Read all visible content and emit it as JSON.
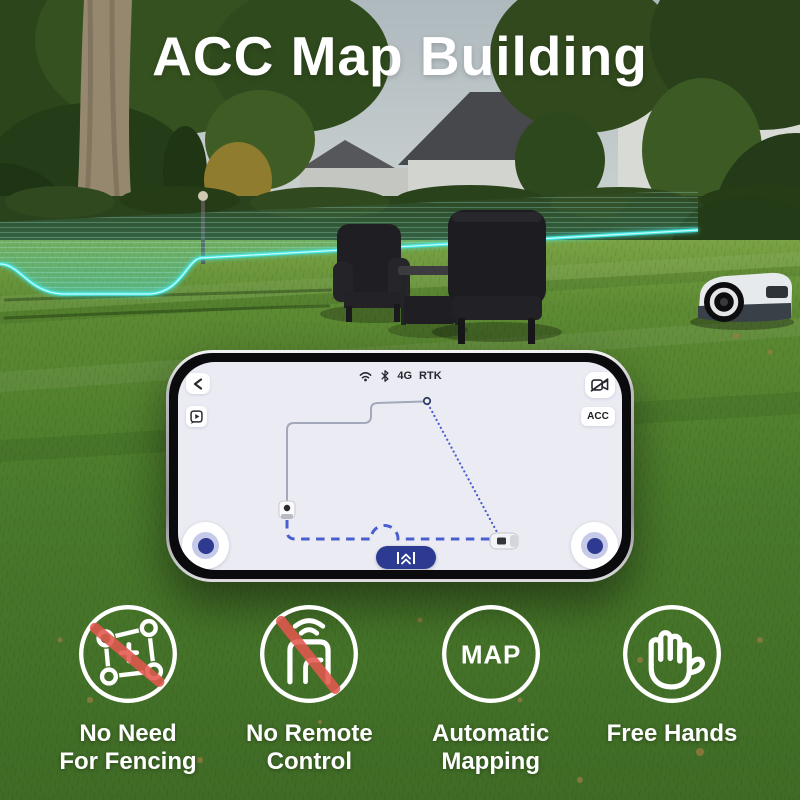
{
  "title": "ACC Map Building",
  "phone": {
    "status_bar": {
      "network": "4G",
      "positioning": "RTK"
    },
    "acc_button_label": "ACC"
  },
  "features": [
    {
      "name": "no-need-for-fencing",
      "icon": "boundary-crossed-icon",
      "label_line1": "No Need",
      "label_line2": "For Fencing"
    },
    {
      "name": "no-remote-control",
      "icon": "remote-signal-crossed-icon",
      "label_line1": "No Remote",
      "label_line2": "Control"
    },
    {
      "name": "automatic-mapping",
      "icon": "map-badge-icon",
      "icon_text": "MAP",
      "label_line1": "Automatic",
      "label_line2": "Mapping"
    },
    {
      "name": "free-hands",
      "icon": "hand-icon",
      "label_line1": "Free Hands",
      "label_line2": ""
    }
  ],
  "icons": {
    "back": "chevron-left-icon",
    "video_guide": "play-bubble-icon",
    "wifi": "wifi-icon",
    "bluetooth": "bluetooth-icon",
    "camera_disabled": "camera-off-icon",
    "drive_forward": "double-chevron-up-icon",
    "docking_station": "dock-station-icon",
    "mower": "robot-mower-icon"
  },
  "colors": {
    "route_blue": "#4a5ed0",
    "accent_navy": "#2c3a92",
    "fence_cyan": "#45e6e2",
    "slash_red": "#e2574e",
    "screen_bg": "#ebecf3"
  }
}
